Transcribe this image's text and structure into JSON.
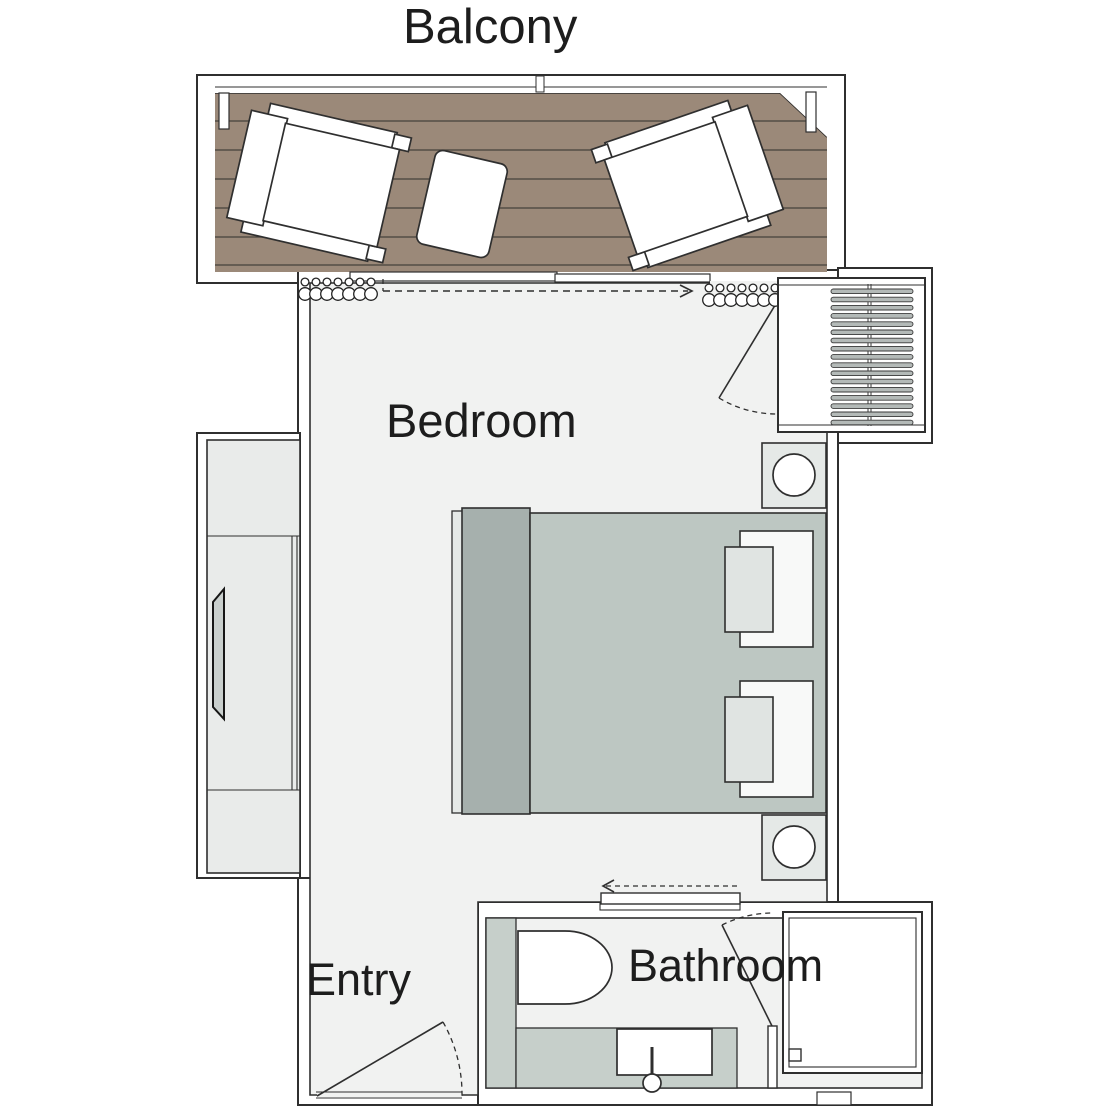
{
  "rooms": {
    "balcony": "Balcony",
    "bedroom": "Bedroom",
    "entry": "Entry",
    "bathroom": "Bathroom"
  },
  "colors": {
    "label": "#1d1d1d",
    "line": "#2f2f2f",
    "floor": "#f1f2f1",
    "deck": "#9b8979",
    "plank": "#45413c",
    "duvet": "#bdc7c2",
    "bedfoot": "#a6b0ad",
    "pillow": "#f8f9f8",
    "pillow2": "#e0e4e2",
    "stand": "#e5e9e7",
    "counter": "#c6cfca",
    "unit": "#e9ebea",
    "bars": "#b4bab8",
    "tv": "#c9cfcd"
  }
}
